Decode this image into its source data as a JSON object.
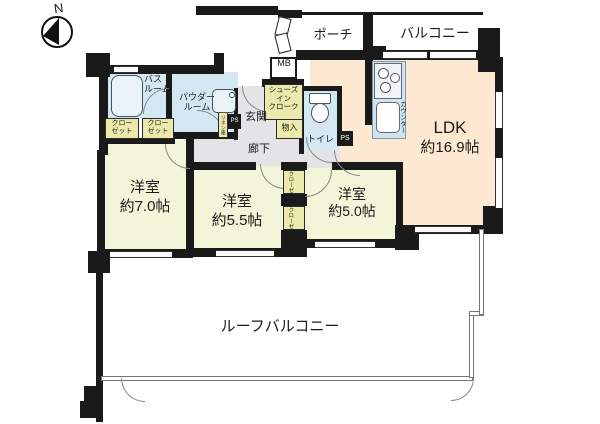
{
  "plan": {
    "north_label": "N",
    "outdoor": {
      "porch": "ポーチ",
      "balcony": "バルコニー",
      "roof_balcony": "ルーフバルコニー"
    },
    "rooms": {
      "ldk": {
        "name": "LDK",
        "size": "約16.9帖"
      },
      "western1": {
        "name": "洋室",
        "size": "約7.0帖"
      },
      "western2": {
        "name": "洋室",
        "size": "約5.5帖"
      },
      "western3": {
        "name": "洋室",
        "size": "約5.0帖"
      }
    },
    "service": {
      "bathroom_line1": "バス",
      "bathroom_line2": "ルーム",
      "powder_line1": "パウダー",
      "powder_line2": "ルーム",
      "toilet": "トイレ",
      "genkan": "玄関",
      "corridor": "廊下",
      "shoes_line1": "シューズ",
      "shoes_line2": "イン",
      "shoes_line3": "クローク",
      "closet_line1": "クロー",
      "closet_line2": "ゼット",
      "closet_vertical": "クローゼット",
      "storage": "物入",
      "linen": "リネン庫",
      "meter_box": "MB",
      "pipe_space": "PS",
      "counter": "カウンター"
    },
    "colors": {
      "wall": "#1a1a1a",
      "western_room_floor": "#f3f5d8",
      "ldk_floor": "#fde8d2",
      "wet_area_floor": "#d3e8f2",
      "closet_floor": "#ece9ad",
      "corridor_floor": "#e4e4e7"
    }
  }
}
